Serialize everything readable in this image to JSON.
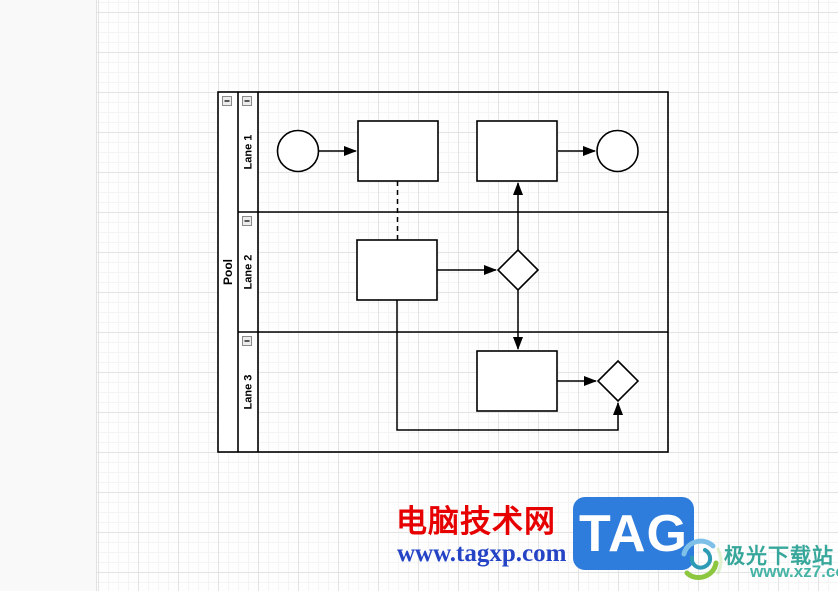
{
  "diagram": {
    "pool_label": "Pool",
    "lanes": [
      "Lane 1",
      "Lane 2",
      "Lane 3"
    ],
    "shape_fill": "#ffffff",
    "shape_stroke": "#000000"
  },
  "watermark_left": {
    "title": "电脑技术网",
    "title_color": "#e60000",
    "url": "www.tagxp.com",
    "url_color": "#2443c5",
    "badge_text": "TAG",
    "badge_bg": "#2e7cdb",
    "badge_text_color": "#ffffff"
  },
  "watermark_right": {
    "site": "极光下载站",
    "url": "www.xz7.com",
    "color": "#38a79b"
  }
}
